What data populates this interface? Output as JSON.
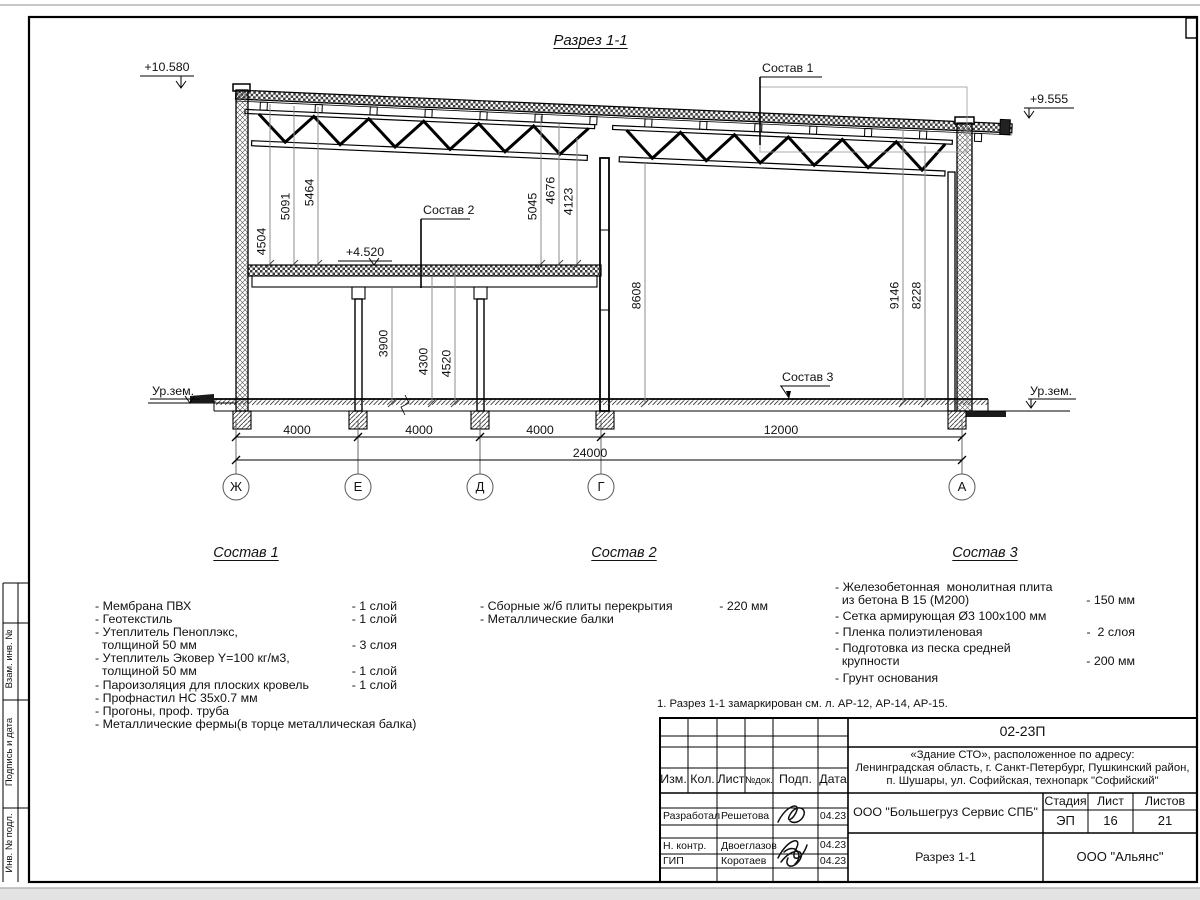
{
  "sheet": {
    "title": "Разрез 1-1",
    "note": "1. Разрез 1-1 замаркирован см. л. АР-12, АР-14, АР-15."
  },
  "elevations": {
    "roof_left": "+10.580",
    "roof_right": "+9.555",
    "floor": "+4.520",
    "ground_left": "Ур.зем.",
    "ground_right": "Ур.зем."
  },
  "callouts": {
    "c1": "Состав 1",
    "c2": "Состав 2",
    "c3": "Состав 3"
  },
  "axes": [
    "Ж",
    "Е",
    "Д",
    "Г",
    "А"
  ],
  "dims": {
    "h": [
      "4000",
      "4000",
      "4000",
      "12000",
      "24000"
    ],
    "v": [
      "4504",
      "5091",
      "5464",
      "5045",
      "4676",
      "4123",
      "3900",
      "4300",
      "4520",
      "8608",
      "9146",
      "8228"
    ]
  },
  "compositions": [
    {
      "title": "Состав 1",
      "items": [
        {
          "t": "- Мембрана ПВХ",
          "q": "- 1 слой"
        },
        {
          "t": "- Геотекстиль",
          "q": "- 1 слой"
        },
        {
          "t": "- Утеплитель Пеноплэкс,",
          "q": ""
        },
        {
          "t": "  толщиной 50 мм",
          "q": "- 3 слоя"
        },
        {
          "t": "- Утеплитель Эковер Y=100 кг/м3,",
          "q": ""
        },
        {
          "t": "  толщиной 50 мм",
          "q": "- 1 слой"
        },
        {
          "t": "- Пароизоляция для плоских кровель",
          "q": "- 1 слой"
        },
        {
          "t": "- Профнастил НС 35х0.7 мм",
          "q": ""
        },
        {
          "t": "- Прогоны, проф. труба",
          "q": ""
        },
        {
          "t": "- Металлические фермы(в торце металлическая балка)",
          "q": ""
        }
      ]
    },
    {
      "title": "Состав 2",
      "items": [
        {
          "t": "- Сборные ж/б плиты перекрытия",
          "q": "- 220 мм"
        },
        {
          "t": "- Металлические балки",
          "q": ""
        }
      ]
    },
    {
      "title": "Состав 3",
      "items": [
        {
          "t": "- Железобетонная  монолитная плита",
          "q": ""
        },
        {
          "t": "  из бетона В 15 (М200)",
          "q": "- 150 мм"
        },
        {
          "t": "- Сетка армирующая Ø3 100х100 мм",
          "q": ""
        },
        {
          "t": "- Пленка полиэтиленовая",
          "q": "-  2 слоя"
        },
        {
          "t": "- Подготовка из песка средней",
          "q": ""
        },
        {
          "t": "  крупности",
          "q": "- 200 мм"
        },
        {
          "t": "- Грунт основания",
          "q": ""
        }
      ]
    }
  ],
  "titleblock": {
    "doc_number": "02-23П",
    "address1": "«Здание СТО», расположенное по адресу:",
    "address2": "Ленинградская область, г. Санкт-Петербург, Пушкинский район,",
    "address3": "п. Шушары, ул. Софийская, технопарк \"Софийский\"",
    "col_izm": "Изм.",
    "col_kol": "Кол.",
    "col_list": "Лист",
    "col_ndok": "№док.",
    "col_podp": "Подп.",
    "col_data": "Дата",
    "rows": [
      {
        "role": "Разработал",
        "name": "Решетова",
        "date": "04.23"
      },
      {
        "role": "Н. контр.",
        "name": "Двоеглазов",
        "date": "04.23"
      },
      {
        "role": "ГИП",
        "name": "Коротаев",
        "date": "04.23"
      }
    ],
    "company": "ООО \"Большегруз Сервис СПБ\"",
    "stage_label": "Стадия",
    "sheet_label": "Лист",
    "sheets_label": "Листов",
    "stage": "ЭП",
    "sheet_no": "16",
    "sheets_total": "21",
    "drawing_name": "Разрез 1-1",
    "org": "ООО \"Альянс\""
  },
  "side_stamps": [
    "Взам. инв. №",
    "Подпись и дата",
    "Инв. № подл."
  ]
}
